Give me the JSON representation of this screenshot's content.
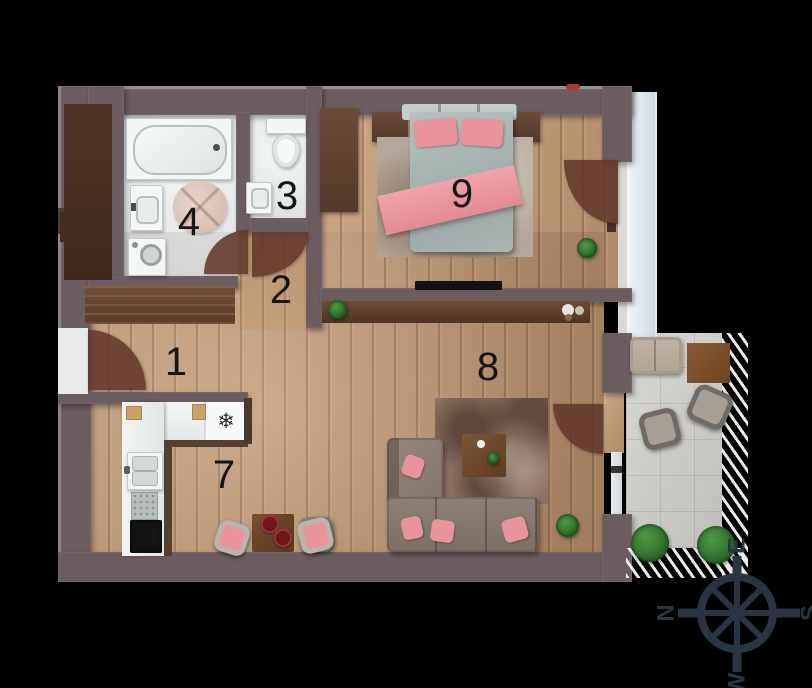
{
  "rooms": [
    {
      "number": "1"
    },
    {
      "number": "2"
    },
    {
      "number": "3"
    },
    {
      "number": "4"
    },
    {
      "number": "7"
    },
    {
      "number": "8"
    },
    {
      "number": "9"
    }
  ],
  "compass": {
    "north": "N",
    "east": "E",
    "south": "S",
    "west": "W"
  },
  "icons": {
    "freezer": "❄"
  },
  "colors": {
    "background": "#000000",
    "wall": "#6b5c60",
    "wood": "#c49b76",
    "dark-wood": "#5d4130",
    "accent-pink": "#e9939c",
    "bath-white": "#eceeee",
    "tile-gray": "#cdccc8",
    "plant-green": "#2f7a33",
    "compass-navy": "#2b3442"
  }
}
